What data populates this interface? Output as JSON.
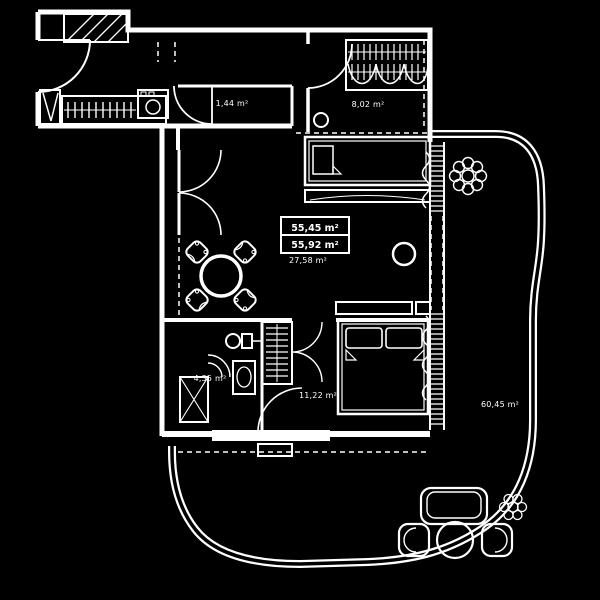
{
  "canvas": {
    "background": "#000000",
    "line_color": "#ffffff"
  },
  "floor_plan": {
    "name": "Apartment floor plan with terrace",
    "summary_box": {
      "area_line1": "55,45 m²",
      "area_line2": "55,92 m²"
    },
    "rooms": {
      "hall_wc": {
        "area": "1,44 m²"
      },
      "bedroom_small": {
        "area": "8,02 m²"
      },
      "living_room": {
        "area": "27,58 m²"
      },
      "bathroom": {
        "area": "4,35 m²"
      },
      "bedroom": {
        "area": "11,22 m²"
      },
      "terrace": {
        "area": "60,45 m²"
      }
    }
  }
}
